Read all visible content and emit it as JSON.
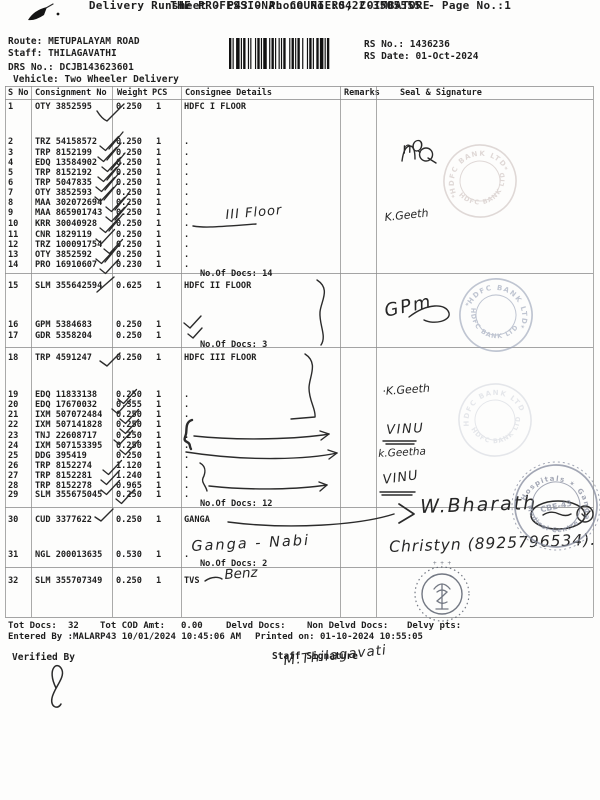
{
  "header": {
    "title": "THE PROFESSIONAL COURIERS, COIMBATORE",
    "subtitle": "Delivery Runsheet - P43 - Phone No.:0422-3505555 - Page No.:1",
    "route_label": "Route:",
    "route": "METUPALAYAM ROAD",
    "staff_label": "Staff:",
    "staff": "THILAGAVATHI",
    "drs_label": "DRS No.:",
    "drs": "DCJB143623601",
    "vehicle_label": "Vehicle:",
    "vehicle": "Two Wheeler Delivery",
    "rs_no_label": "RS No.:",
    "rs_no": "1436236",
    "rs_date_label": "RS Date:",
    "rs_date": "01-Oct-2024"
  },
  "table": {
    "columns": [
      "S No",
      "Consignment No",
      "Weight",
      "PCS",
      "Consignee Details",
      "Remarks",
      "Seal & Signature"
    ],
    "rows": [
      {
        "no": "1",
        "consignment": "OTY 3852595",
        "weight": "0.250",
        "pcs": "1",
        "consignee": "HDFC I FLOOR"
      },
      {
        "no": "2",
        "consignment": "TRZ 54158572",
        "weight": "0.250",
        "pcs": "1",
        "consignee": "."
      },
      {
        "no": "3",
        "consignment": "TRP 8152199",
        "weight": "0.250",
        "pcs": "1",
        "consignee": "."
      },
      {
        "no": "4",
        "consignment": "EDQ 13584902",
        "weight": "0.250",
        "pcs": "1",
        "consignee": "."
      },
      {
        "no": "5",
        "consignment": "TRP 8152192",
        "weight": "0.250",
        "pcs": "1",
        "consignee": "."
      },
      {
        "no": "6",
        "consignment": "TRP 5047835",
        "weight": "0.250",
        "pcs": "1",
        "consignee": "."
      },
      {
        "no": "7",
        "consignment": "OTY 3852593",
        "weight": "0.250",
        "pcs": "1",
        "consignee": "."
      },
      {
        "no": "8",
        "consignment": "MAA 302072694",
        "weight": "0.250",
        "pcs": "1",
        "consignee": "."
      },
      {
        "no": "9",
        "consignment": "MAA 865901743",
        "weight": "0.250",
        "pcs": "1",
        "consignee": "."
      },
      {
        "no": "10",
        "consignment": "KRR 30040928",
        "weight": "0.250",
        "pcs": "1",
        "consignee": "."
      },
      {
        "no": "11",
        "consignment": "CNR 1829119",
        "weight": "0.250",
        "pcs": "1",
        "consignee": "."
      },
      {
        "no": "12",
        "consignment": "TRZ 100091754",
        "weight": "0.250",
        "pcs": "1",
        "consignee": "."
      },
      {
        "no": "13",
        "consignment": "OTY 3852592",
        "weight": "0.250",
        "pcs": "1",
        "consignee": "."
      },
      {
        "no": "14",
        "consignment": "PRO 16910607",
        "weight": "0.230",
        "pcs": "1",
        "consignee": "."
      },
      {
        "no": "15",
        "consignment": "SLM 355642594",
        "weight": "0.625",
        "pcs": "1",
        "consignee": "HDFC II FLOOR"
      },
      {
        "no": "16",
        "consignment": "GPM 5384683",
        "weight": "0.250",
        "pcs": "1",
        "consignee": ""
      },
      {
        "no": "17",
        "consignment": "GDR 5358204",
        "weight": "0.250",
        "pcs": "1",
        "consignee": ""
      },
      {
        "no": "18",
        "consignment": "TRP 4591247",
        "weight": "0.250",
        "pcs": "1",
        "consignee": "HDFC III FLOOR"
      },
      {
        "no": "19",
        "consignment": "EDQ 11833138",
        "weight": "0.250",
        "pcs": "1",
        "consignee": "."
      },
      {
        "no": "20",
        "consignment": "EDQ 17670032",
        "weight": "0.355",
        "pcs": "1",
        "consignee": "."
      },
      {
        "no": "21",
        "consignment": "IXM 507072484",
        "weight": "0.250",
        "pcs": "1",
        "consignee": "."
      },
      {
        "no": "22",
        "consignment": "IXM 507141828",
        "weight": "0.250",
        "pcs": "1",
        "consignee": "."
      },
      {
        "no": "23",
        "consignment": "TNJ 22608717",
        "weight": "0.250",
        "pcs": "1",
        "consignee": "."
      },
      {
        "no": "24",
        "consignment": "IXM 507153395",
        "weight": "0.250",
        "pcs": "1",
        "consignee": "."
      },
      {
        "no": "25",
        "consignment": "DDG 395419",
        "weight": "0.250",
        "pcs": "1",
        "consignee": "."
      },
      {
        "no": "26",
        "consignment": "TRP 8152274",
        "weight": "1.120",
        "pcs": "1",
        "consignee": "."
      },
      {
        "no": "27",
        "consignment": "TRP 8152281",
        "weight": "1.240",
        "pcs": "1",
        "consignee": "."
      },
      {
        "no": "28",
        "consignment": "TRP 8152278",
        "weight": "0.965",
        "pcs": "1",
        "consignee": "."
      },
      {
        "no": "29",
        "consignment": "SLM 355675045",
        "weight": "0.250",
        "pcs": "1",
        "consignee": "."
      },
      {
        "no": "30",
        "consignment": "CUD 3377622",
        "weight": "0.250",
        "pcs": "1",
        "consignee": "GANGA"
      },
      {
        "no": "31",
        "consignment": "NGL 200013635",
        "weight": "0.530",
        "pcs": "1",
        "consignee": "."
      },
      {
        "no": "32",
        "consignment": "SLM 355707349",
        "weight": "0.250",
        "pcs": "1",
        "consignee": "TVS"
      }
    ],
    "docs_counts": [
      "No.Of Docs: 14",
      "No.Of Docs: 3",
      "No.Of Docs: 12",
      "No.Of Docs: 2"
    ]
  },
  "footer": {
    "tot_docs_label": "Tot Docs:",
    "tot_docs": "32",
    "tot_cod_label": "Tot COD Amt:",
    "tot_cod": "0.00",
    "delvd_label": "Delvd Docs:",
    "non_delvd_label": "Non Delvd Docs:",
    "delvy_label": "Delvy pts:",
    "entered_by": "Entered By :MALARP43 10/01/2024 10:45:06 AM",
    "printed_on": "Printed on: 01-10-2024 10:55:05",
    "verified_by_label": "Verified By",
    "staff_signature_label": "Staff Signature"
  },
  "handwriting": {
    "floor_note": "III Floor",
    "nq_mark": "nQ",
    "sig_k_geeth_1": "K.Geeth",
    "sig_gpm": "GPm",
    "sig_k_geeth_2": "·K.Geeth",
    "sig_vinu_1": "VINU",
    "sig_k_geetha": "k.Geetha",
    "sig_vinu_2": "VINU",
    "sig_bharath": "W.Bharath",
    "sig_contact": "Christyn (8925796534).",
    "note_ganga_nabi": "Ganga - Nabi",
    "note_benz": "Benz",
    "staff_signature": "M.Thilagavati"
  },
  "stamps": {
    "hdfc_rim": "HDFC BANK LTD",
    "ganga_rim_top": "Hospitals ✶ Ganga",
    "ganga_rim_bottom": "Medical Centre",
    "ganga_center": "CBE-43"
  }
}
